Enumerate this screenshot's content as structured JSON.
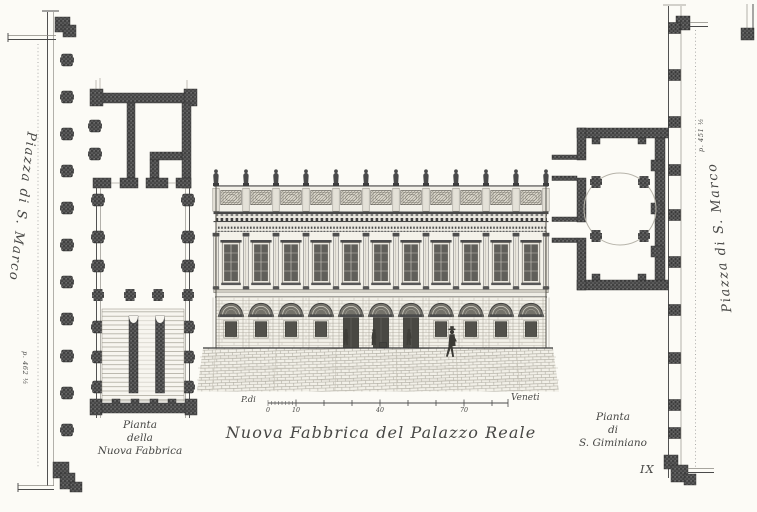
{
  "plate": {
    "number": "IX"
  },
  "captions": {
    "main": "Nuova Fabbrica del Palazzo Reale",
    "left_plan": {
      "line1": "Pianta",
      "line2": "della",
      "line3": "Nuova Fabbrica"
    },
    "right_plan": {
      "line1": "Pianta",
      "line2": "di",
      "line3": "S. Giminiano"
    }
  },
  "margins": {
    "left": {
      "label": "Piazza di S. Marco",
      "measure": "p. 462 ½"
    },
    "right": {
      "label": "Piazza di S. Marco",
      "measure": "p. 451 ½"
    }
  },
  "scale_bar": {
    "left_label": "P.di",
    "right_label": "Veneti",
    "ticks": {
      "t0": "0",
      "t10": "10",
      "t40": "40",
      "t70": "70"
    }
  },
  "colors": {
    "paper": "#fcfbf6",
    "ink": "#3c3c3c",
    "wall_dark": "#4a4a4a",
    "faint_line": "#b6b3a9"
  }
}
